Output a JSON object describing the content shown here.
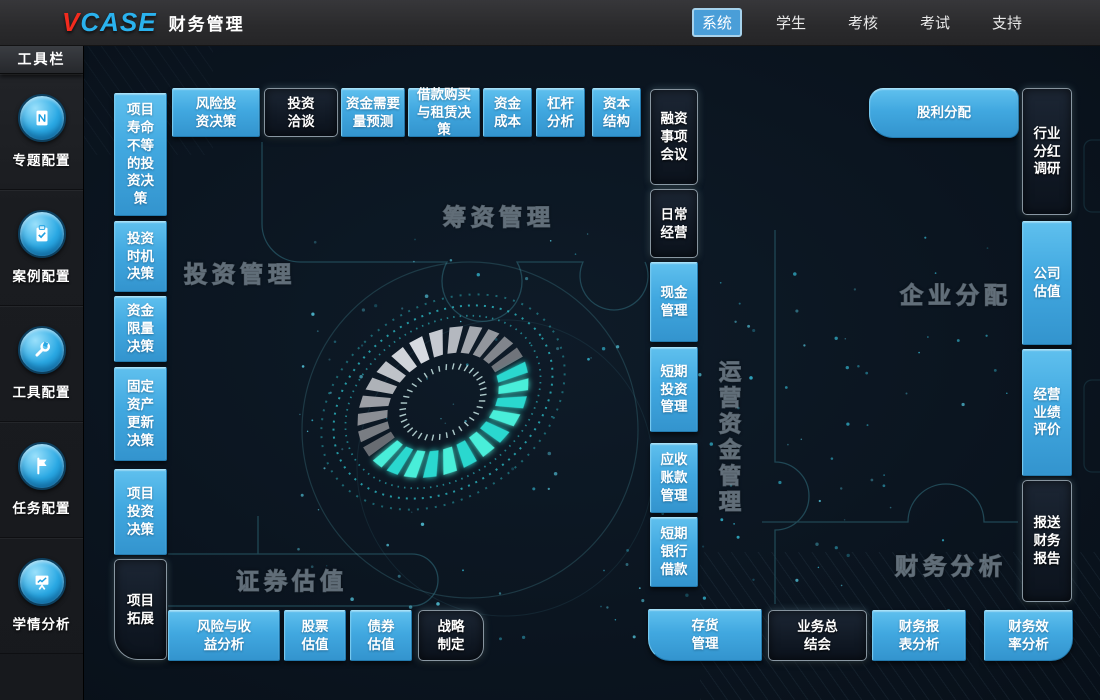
{
  "topbar": {
    "logo_v": "V",
    "logo_rest": "CASE",
    "title": "财务管理",
    "menu": [
      {
        "label": "系统",
        "active": true
      },
      {
        "label": "学生",
        "active": false
      },
      {
        "label": "考核",
        "active": false
      },
      {
        "label": "考试",
        "active": false
      },
      {
        "label": "支持",
        "active": false
      }
    ]
  },
  "sidebar": {
    "header": "工具栏",
    "items": [
      {
        "label": "专题配置",
        "icon": "book-icon"
      },
      {
        "label": "案例配置",
        "icon": "clipboard-icon"
      },
      {
        "label": "工具配置",
        "icon": "wrench-icon"
      },
      {
        "label": "任务配置",
        "icon": "flag-icon"
      },
      {
        "label": "学情分析",
        "icon": "chart-board-icon"
      }
    ]
  },
  "regions": {
    "investment": "投资管理",
    "financing": "筹资管理",
    "securities": "证券估值",
    "working_capital": "运营资金管理",
    "distribution": "企业分配",
    "analysis": "财务分析"
  },
  "tiles": {
    "project_life": "项目寿命不等的投资决策",
    "investment_timing": "投资时机决策",
    "capital_limit": "资金限量决策",
    "fixed_asset_renewal": "固定资产更新决策",
    "project_investment": "项目投资决策",
    "project_expansion": "项目拓展",
    "venture_decision": "风险投资决策",
    "investment_negotiation": "投资洽谈",
    "capital_forecast": "资金需要量预测",
    "loan_lease": "借款购买与租赁决策",
    "capital_cost": "资金成本",
    "leverage_analysis": "杠杆分析",
    "capital_structure": "资本结构",
    "financing_meeting": "融资事项会议",
    "daily_operation": "日常经营",
    "cash_mgmt": "现金管理",
    "short_term_investment": "短期投资管理",
    "receivables_mgmt": "应收账款管理",
    "short_term_bank_loan": "短期银行借款",
    "risk_return": "风险与收益分析",
    "stock_valuation": "股票估值",
    "bond_valuation": "债券估值",
    "strategy": "战略制定",
    "inventory_mgmt": "存货管理",
    "business_summary": "业务总结会",
    "financial_statement_analysis": "财务报表分析",
    "financial_efficiency_analysis": "财务效率分析",
    "dividend_distribution": "股利分配",
    "industry_dividend_research": "行业分红调研",
    "company_valuation": "公司估值",
    "performance_evaluation": "经营业绩评价",
    "financial_reporting": "报送财务报告"
  },
  "colors": {
    "tile_blue": "#41a8e0",
    "tile_dark": "#101824",
    "teal_glow": "#39e6d2",
    "navbar": "#2a2a2c",
    "active_menu": "#4a9ed8"
  }
}
